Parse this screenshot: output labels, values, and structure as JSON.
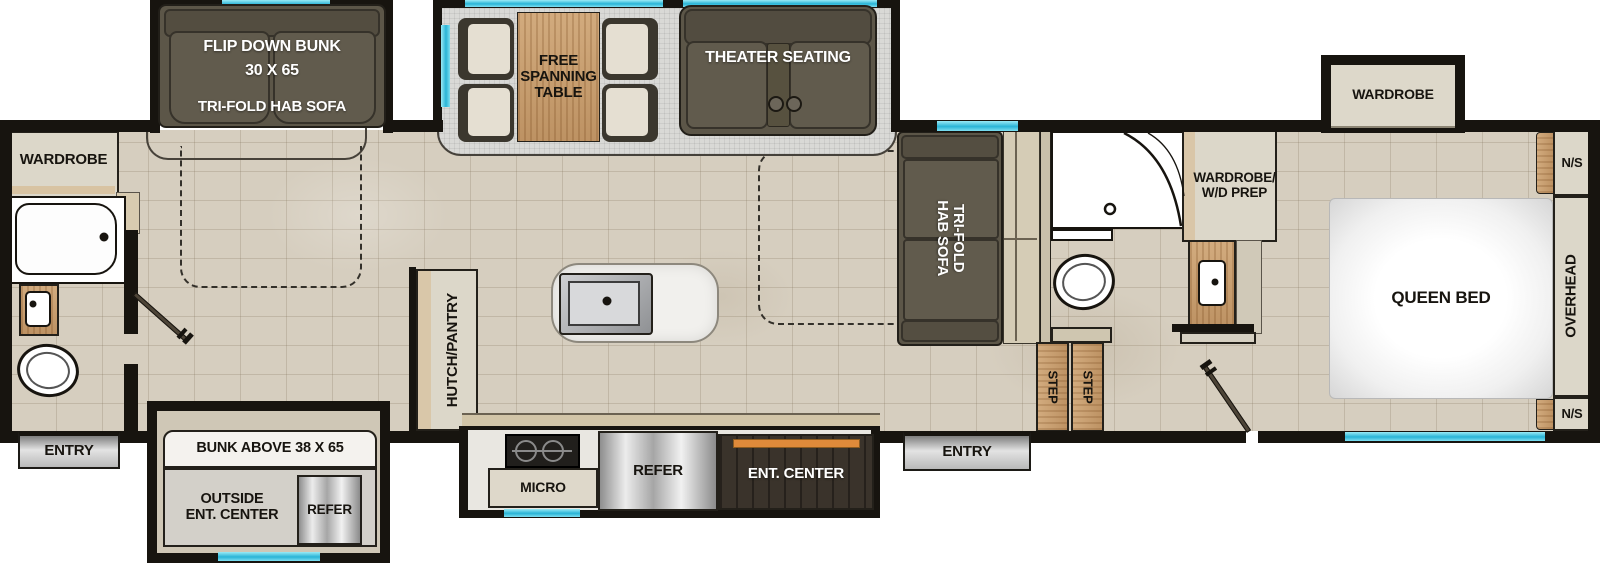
{
  "colors": {
    "wall": "#17140f",
    "window_cyan": "#3cc6e2",
    "floor_tile": "#d6cebf",
    "slide_floor_gray": "#d9d9d6",
    "sofa_dark": "#5c5648",
    "wood_tan": "#c9a071",
    "accent_orange": "#df8a3a",
    "cabinet_beige": "#dcd7c9",
    "dark_wood": "#3a332b"
  },
  "slide_flip_bunk": {
    "bunk_line1": "FLIP DOWN BUNK",
    "bunk_line2": "30 X 65",
    "sofa": "TRI-FOLD HAB SOFA"
  },
  "slide_dinette": {
    "table_line1": "FREE",
    "table_line2": "SPANNING",
    "table_line3": "TABLE",
    "theater": "THEATER SEATING"
  },
  "slide_bedroom": {
    "wardrobe": "WARDROBE"
  },
  "slide_lower_bunk": {
    "bunk": "BUNK ABOVE 38 X 65",
    "outside_line1": "OUTSIDE",
    "outside_line2": "ENT. CENTER",
    "refer": "REFER"
  },
  "slide_kitchen": {
    "micro": "MICRO",
    "refer": "REFER",
    "ent_center": "ENT. CENTER"
  },
  "rear_bath": {
    "wardrobe": "WARDROBE",
    "entry": "ENTRY"
  },
  "living": {
    "hutch": "HUTCH/PANTRY"
  },
  "mid_bath": {
    "sofa_line1": "TRI-FOLD",
    "sofa_line2": "HAB SOFA",
    "wardrobe_wd_line1": "WARDROBE/",
    "wardrobe_wd_line2": "W/D PREP",
    "step_left": "STEP",
    "step_right": "STEP",
    "entry": "ENTRY"
  },
  "bedroom": {
    "bed": "QUEEN BED",
    "overhead": "OVERHEAD",
    "ns_top": "N/S",
    "ns_bottom": "N/S"
  }
}
